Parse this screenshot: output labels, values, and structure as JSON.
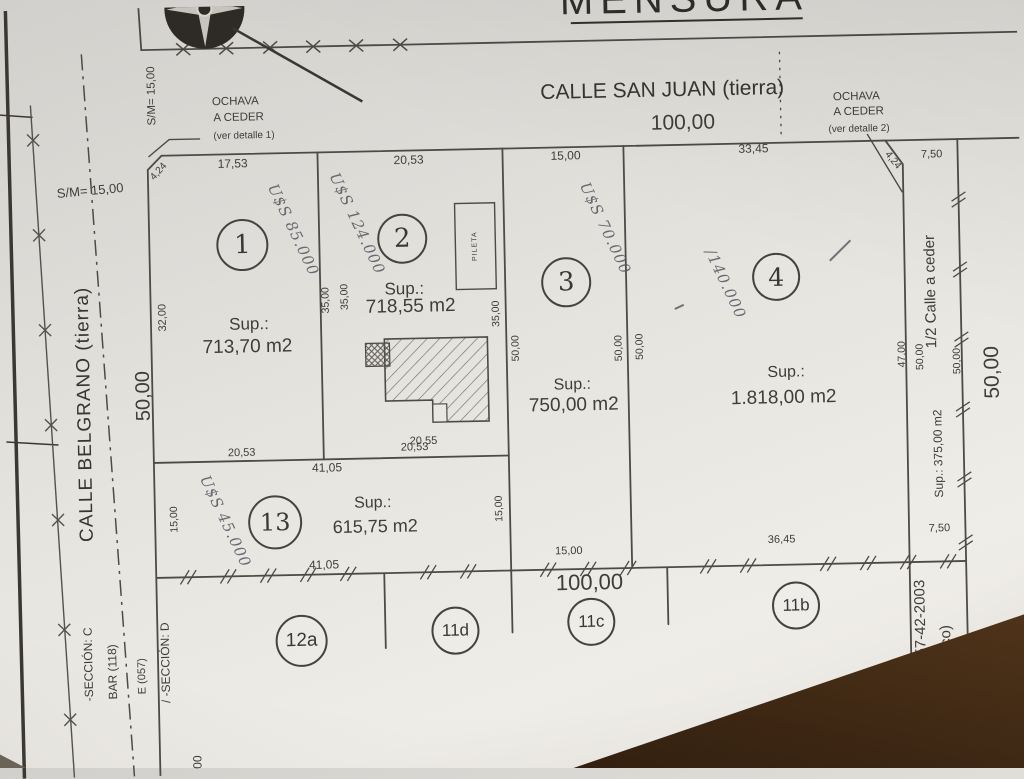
{
  "title": "MENSURA",
  "streets": {
    "san_juan": {
      "name": "CALLE SAN JUAN (tierra)",
      "width": "100,00"
    },
    "belgrano": {
      "name": "CALLE BELGRANO (tierra)",
      "width": "50,00",
      "sm_top": "S/M= 15,00",
      "sm_side": "S/M= 15,00"
    }
  },
  "ochava_left": {
    "l1": "OCHAVA",
    "l2": "A CEDER",
    "l3": "(ver detalle 1)",
    "dim": "4,24"
  },
  "ochava_right": {
    "l1": "OCHAVA",
    "l2": "A CEDER",
    "l3": "(ver detalle 2)",
    "dim": "4,24"
  },
  "parcels": {
    "p1": {
      "num": "1",
      "sup": "Sup.:",
      "area": "713,70 m2",
      "price": "U$S 85.000",
      "top": "17,53",
      "left": "32,00",
      "side_a": "35,00",
      "side_b": "35,00"
    },
    "p2": {
      "num": "2",
      "sup": "Sup.:",
      "area": "718,55 m2",
      "price": "U$S 124.000",
      "top": "20,53",
      "front": "20,55",
      "pool": "PILETA"
    },
    "p3": {
      "num": "3",
      "sup": "Sup.:",
      "area": "750,00 m2",
      "price": "U$S 70.000",
      "top": "15,00",
      "bottom": "15,00",
      "west_a": "35,00",
      "west_b": "50,00",
      "east_a": "50,00",
      "east_b": "50,00"
    },
    "p4": {
      "num": "4",
      "sup": "Sup.:",
      "area": "1.818,00 m2",
      "price": "/140.000",
      "top": "33,45",
      "bottom": "36,45"
    },
    "p13": {
      "num": "13",
      "sup": "Sup.:",
      "area": "615,75 m2",
      "price": "U$S 45.000",
      "top": "41,05",
      "bottom": "41,05",
      "left": "15,00",
      "right": "15,00",
      "above_a": "20,53",
      "above_b": "20,53"
    }
  },
  "half_street": {
    "label": "1/2 Calle a ceder",
    "sup": "Sup.: 375,00 m2",
    "top": "7,50",
    "bottom": "7,50",
    "left": "47,00",
    "mid": "50,00",
    "right": "50,00",
    "outer": "50,00"
  },
  "bottom": {
    "total": "100,00",
    "lots": [
      "12a",
      "11d",
      "11c",
      "11b"
    ],
    "plano_1": "ano 057-42-2003",
    "plano_2": "público)",
    "partial": "0,00"
  },
  "margin": {
    "seccion_c": "-SECCIÓN: C",
    "bar": "BAR (118)",
    "e057": "E (057)",
    "seccion_d": "/ -SECCIÓN: D",
    "partial": "00"
  },
  "colors": {
    "paper": "#e5e3de",
    "ink": "#4e4b47",
    "pen": "#54545e",
    "desk": "#5e4023"
  }
}
